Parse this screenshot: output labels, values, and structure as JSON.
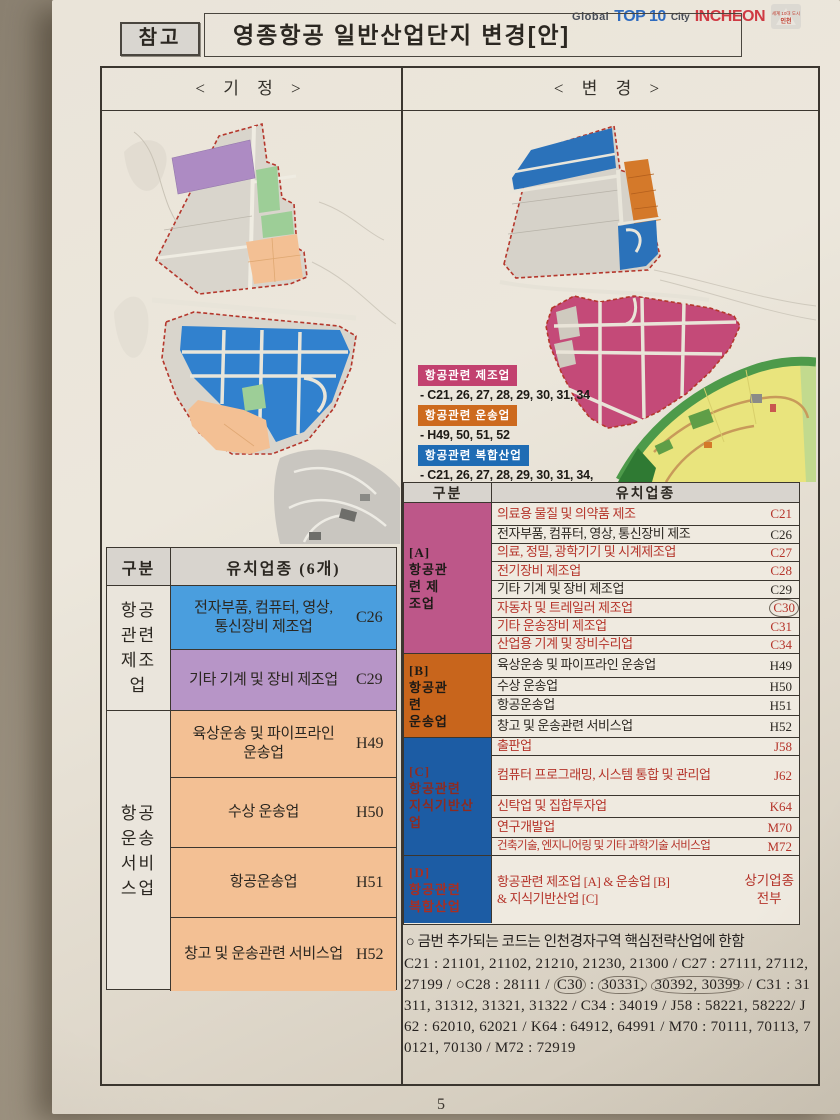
{
  "header": {
    "ref_label": "참고",
    "title": "영종항공 일반산업단지 변경[안]",
    "logo": {
      "global": "Global",
      "top": "TOP 10",
      "city": "City",
      "incheon": "INCHEON",
      "emblem_line1": "세계 10대 도시",
      "emblem_line2": "인천"
    }
  },
  "panels": {
    "left": "< 기  정 >",
    "right": "< 변  경 >"
  },
  "legend": {
    "items": [
      {
        "label": "항공관련 제조업",
        "color": "#c2416f",
        "line1": "- C21, 26, 27, 28, 29, 30, 31, 34"
      },
      {
        "label": "항공관련 운송업",
        "color": "#cd6a1e",
        "line1": "- H49, 50, 51, 52"
      },
      {
        "label": "항공관련 복합산업",
        "color": "#1f6cb4",
        "line1": "- C21, 26, 27, 28, 29, 30, 31, 34,",
        "line2": "- H49, 50, 51, 52",
        "line3": "- J58, 62, K64, M70, 72"
      }
    ]
  },
  "left_table": {
    "col1_header": "구분",
    "col2_header": "유치업종 (6개)",
    "groups": [
      {
        "label": "항공\n관련\n제조\n업",
        "rows": [
          {
            "name": "전자부품, 컴퓨터, 영상,\n통신장비 제조업",
            "code": "C26"
          },
          {
            "name": "기타 기계 및 장비 제조업",
            "code": "C29"
          }
        ]
      },
      {
        "label": "항공\n운송\n서비\n스업",
        "rows": [
          {
            "name": "육상운송 및 파이프라인\n운송업",
            "code": "H49"
          },
          {
            "name": "수상 운송업",
            "code": "H50"
          },
          {
            "name": "항공운송업",
            "code": "H51"
          },
          {
            "name": "창고 및 운송관련 서비스업",
            "code": "H52"
          }
        ]
      }
    ]
  },
  "right_table": {
    "col1_header": "구분",
    "col2_header": "유치업종",
    "groups": [
      {
        "label": "[A]\n항공관\n련   제\n조업",
        "rows": [
          {
            "name": "의료용 물질 및 의약품 제조",
            "code": "C21"
          },
          {
            "name": "전자부품, 컴퓨터, 영상, 통신장비 제조",
            "code": "C26"
          },
          {
            "name": "의료, 정밀, 광학기기 및 시계제조업",
            "code": "C27"
          },
          {
            "name": "전기장비 제조업",
            "code": "C28"
          },
          {
            "name": "기타 기계 및 장비 제조업",
            "code": "C29"
          },
          {
            "name": "자동차 및 트레일러 제조업",
            "code": "C30"
          },
          {
            "name": "기타 운송장비 제조업",
            "code": "C31"
          },
          {
            "name": "산업용 기계 및 장비수리업",
            "code": "C34"
          }
        ]
      },
      {
        "label": "[B]\n항공관\n련\n운송업",
        "rows": [
          {
            "name": "육상운송 및 파이프라인 운송업",
            "code": "H49"
          },
          {
            "name": "수상 운송업",
            "code": "H50"
          },
          {
            "name": "항공운송업",
            "code": "H51"
          },
          {
            "name": "창고 및 운송관련 서비스업",
            "code": "H52"
          }
        ]
      },
      {
        "label": "[C]\n항공관련\n지식기반산\n업",
        "rows": [
          {
            "name": "출판업",
            "code": "J58"
          },
          {
            "name": "컴퓨터 프로그래밍, 시스템 통합 및 관리업",
            "code": "J62"
          },
          {
            "name": "신탁업 및 집합투자업",
            "code": "K64"
          },
          {
            "name": "연구개발업",
            "code": "M70"
          },
          {
            "name": "건축기술, 엔지니어링 및 기타 과학기술 서비스업",
            "code": "M72"
          }
        ]
      },
      {
        "label": "[D]\n항공관련\n복합산업",
        "rows": [
          {
            "name": "항공관련 제조업 [A] & 운송업 [B]\n& 지식기반산업 [C]",
            "code": "상기업종\n전부"
          }
        ]
      }
    ]
  },
  "note": {
    "bullet": "○ 금번 추가되는 코드는 인천경자구역 핵심전략산업에 한함",
    "p0": "C21 : 21101, 21102, 21210, 21230, 21300 / C27 : 27111, 27112, 27199 / ○C28 : 28111 / ",
    "p1": "C30",
    "p2": " : ",
    "p3": "30331,",
    "p4": " ",
    "p5": "30392, 30399",
    "p6": " / C31 : 31311, 31312, 31321, 31322 / C34 : 34019 / J58 : 58221, 58222/ J62 : 62010, 62021 / K64 : 64912, 64991 / M70 : 70111, 70113, 70121, 70130 / M72 : 72919"
  },
  "page": {
    "number": "5"
  },
  "colors": {
    "manufacturing": "#c2416f",
    "transport": "#cd6a1e",
    "complex": "#1f6cb4",
    "zone_blue": "#4a9ede",
    "zone_purple": "#b795c7",
    "zone_orange": "#f3c094",
    "zone_green": "#9dce97",
    "red_text": "#b5342a",
    "boundary_red": "#b5372c"
  }
}
